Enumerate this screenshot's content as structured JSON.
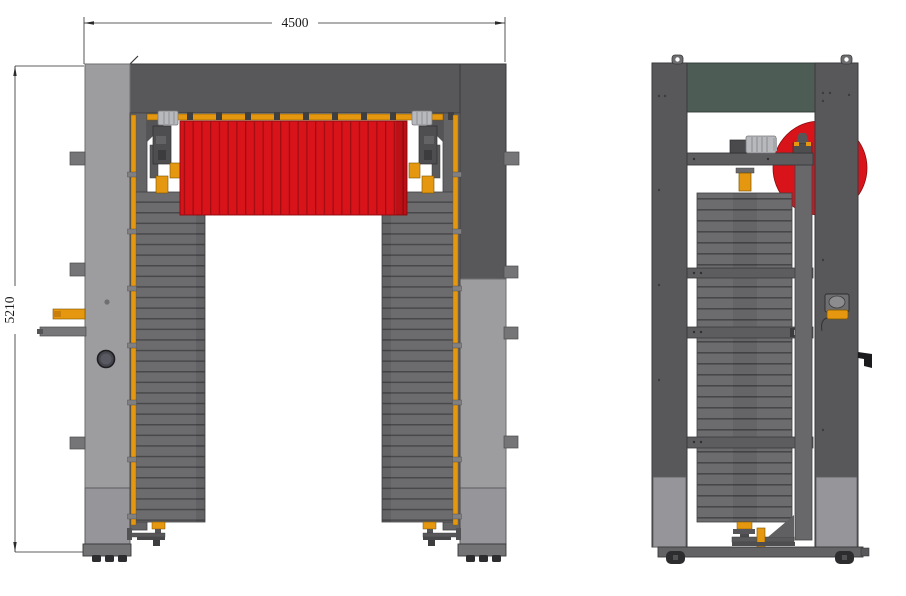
{
  "drawing": {
    "width_dimension_label": "4500",
    "height_dimension_label": "5210"
  },
  "colors": {
    "background": "#ffffff",
    "frame_dark": "#58585a",
    "frame_outline": "#3a3a3c",
    "frame_light": "#9d9d9f",
    "frame_light_outline": "#6f6f71",
    "inner_post": "#646466",
    "beam_mid": "#77777a",
    "brush_gray": "#6c6c6e",
    "brush_line": "#48484b",
    "top_brush_red": "#d8131a",
    "red_stripe": "#a20d11",
    "accent_orange": "#e5980f",
    "panel_green": "#4d5c55",
    "motor_silver": "#b8b9bd",
    "wheel_dark": "#2d2d2f",
    "dimension_line": "#2a2a2a"
  }
}
